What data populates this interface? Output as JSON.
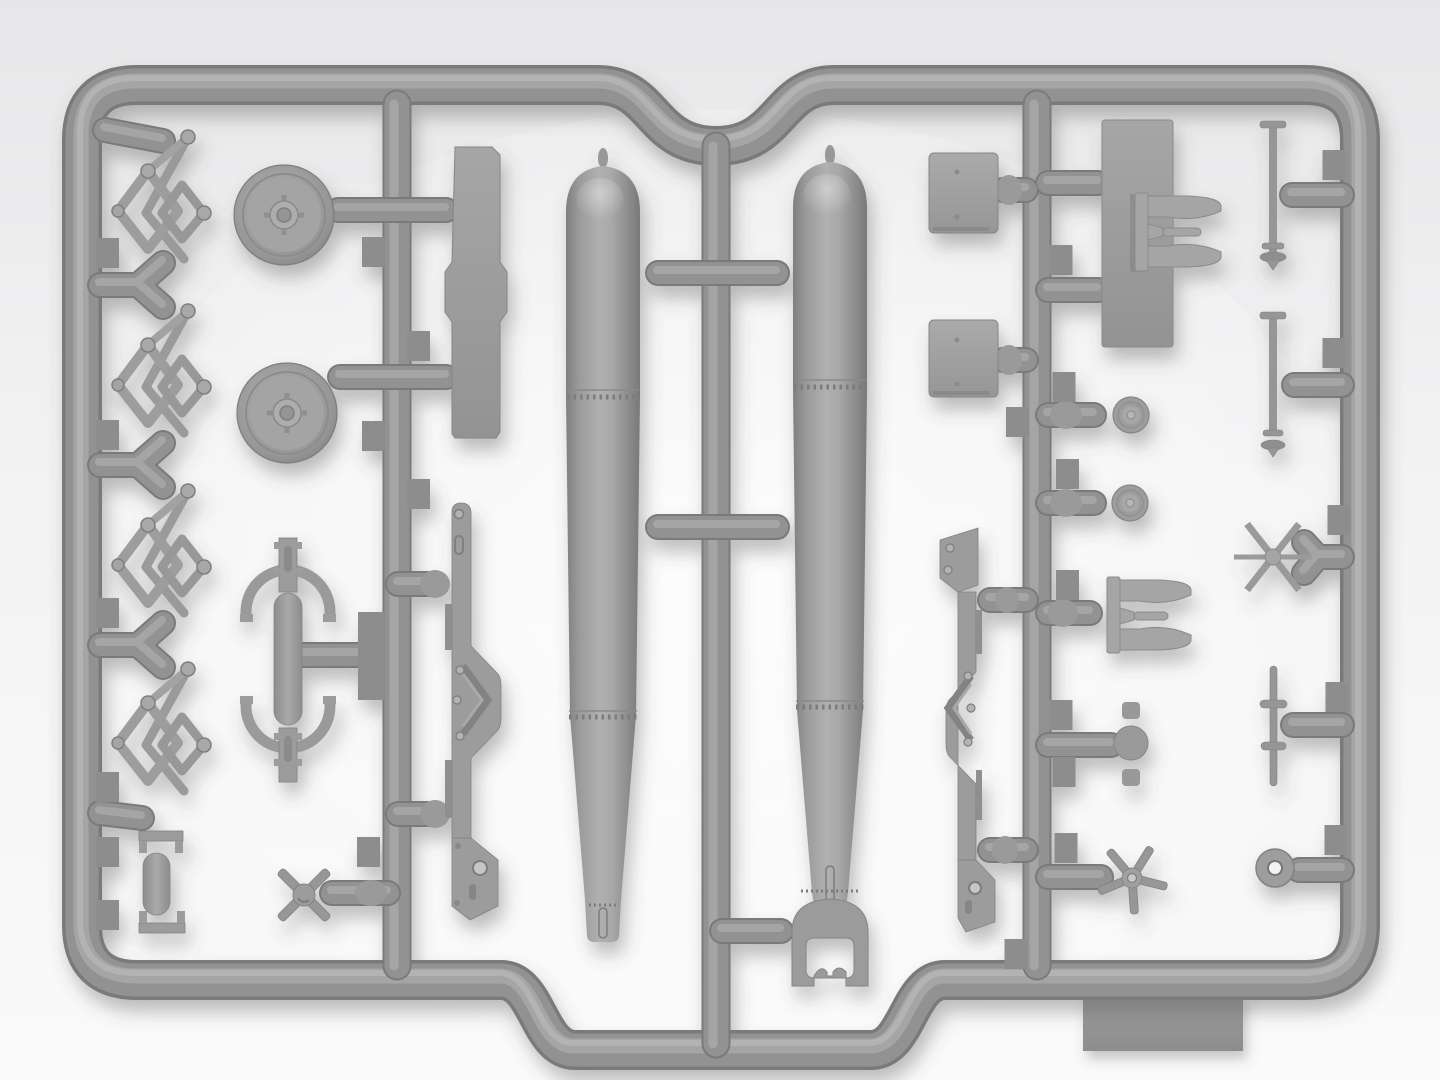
{
  "meta": {
    "title": "Gray plastic model-kit sprue with two aerial torpedoes and fittings",
    "description": "Top-down photo of a light gray injection-molded sprue on a white surface. Rounded rectangular runner frame with a scalloped notch top-center and an offset lower rail bottom-center. Parts: four scissor-linkage brackets, two road wheels, a saddle clamp, a channel bracket, rack rails, two long torpedo bodies (right one with tail guard), flat square plates, a large rectangular plate, two clevis forks, small pulleys, propellers, axle rods, a six-spoke star and a washer ring. A molded rectangular tab protrudes under the lower right frame."
  },
  "palette": {
    "c_bg_top": "#e7e7e9",
    "c_bg_mid": "#f3f3f4",
    "c_bg_bottom": "#fafafa",
    "c_tube": "#929292",
    "c_tube_dark": "#7a7a7a",
    "c_tube_light": "#a8a8a8",
    "c_tube_lighter": "#bcbcbc",
    "c_plastic": "#9c9c9c",
    "c_plastic_light": "#aeaeae",
    "c_plastic_dark": "#828282",
    "c_tab": "#8d8d8d",
    "c_line": "#7c7c7c",
    "c_hole": "#f1f1f1",
    "c_shadow": "#4e4e4e"
  },
  "sprue": {
    "frame_style": "rounded rectangle, concave scallop top-center, lowered rail bottom-center",
    "vertical_runners": 3,
    "gate_tab_size": {
      "w": 23,
      "h": 30
    },
    "gate_tab_centers": [
      [
        107.5,
        253
      ],
      [
        107.5,
        435
      ],
      [
        107.5,
        613
      ],
      [
        107.5,
        787
      ],
      [
        107.5,
        852
      ],
      [
        107.5,
        915
      ],
      [
        373.5,
        252
      ],
      [
        373.5,
        436
      ],
      [
        418.5,
        346
      ],
      [
        418.5,
        494
      ],
      [
        368.5,
        852
      ],
      [
        1061,
        260
      ],
      [
        1064,
        387
      ],
      [
        1067.5,
        474
      ],
      [
        1067.5,
        585
      ],
      [
        1061,
        715
      ],
      [
        1064,
        772
      ],
      [
        1066,
        848
      ],
      [
        1017.5,
        422
      ],
      [
        1016,
        954
      ],
      [
        1334,
        165
      ],
      [
        1334,
        353
      ],
      [
        1339,
        520
      ],
      [
        1337,
        697
      ],
      [
        1336,
        840
      ]
    ]
  },
  "parts_positions": {
    "grapnel_linkage": [
      [
        160,
        199
      ],
      [
        160,
        373
      ],
      [
        160,
        553
      ],
      [
        160,
        731
      ]
    ],
    "road_wheel": [
      [
        284,
        215
      ],
      [
        287,
        413
      ]
    ],
    "small_disc": [
      [
        1131,
        415
      ],
      [
        1130,
        503
      ]
    ]
  },
  "parts_inventory": [
    {
      "name": "scissor-linkage bracket",
      "qty": 4,
      "area": "left column"
    },
    {
      "name": "road wheel with hub",
      "qty": 2,
      "area": "left-center"
    },
    {
      "name": "saddle clamp with band arcs",
      "qty": 1,
      "area": "center-left"
    },
    {
      "name": "channel bracket",
      "qty": 1,
      "area": "bottom-left"
    },
    {
      "name": "four-blade propeller",
      "qty": 1,
      "area": "bottom-left"
    },
    {
      "name": "notched plate column",
      "qty": 1,
      "area": "left of torpedo 1"
    },
    {
      "name": "torpedo rack rail",
      "qty": 2,
      "area": "flanking torpedoes"
    },
    {
      "name": "torpedo body",
      "qty": 2,
      "area": "center"
    },
    {
      "name": "torpedo tail guard",
      "qty": 1,
      "area": "bottom of torpedo 2"
    },
    {
      "name": "flat square plate",
      "qty": 2,
      "area": "right of torpedo 2"
    },
    {
      "name": "large rectangular plate",
      "qty": 1,
      "area": "upper right"
    },
    {
      "name": "clevis fork",
      "qty": 2,
      "area": "right column"
    },
    {
      "name": "small pulley disc",
      "qty": 2,
      "area": "right column"
    },
    {
      "name": "round pad with two blocks",
      "qty": 1,
      "area": "lower right"
    },
    {
      "name": "five-blade propeller",
      "qty": 1,
      "area": "lower right"
    },
    {
      "name": "axle rod with collars",
      "qty": 3,
      "area": "far right"
    },
    {
      "name": "six-spoke star wheel",
      "qty": 1,
      "area": "far right"
    },
    {
      "name": "washer ring",
      "qty": 1,
      "area": "far right bottom"
    },
    {
      "name": "molded rectangular tab",
      "qty": 1,
      "area": "below bottom-right frame"
    }
  ]
}
